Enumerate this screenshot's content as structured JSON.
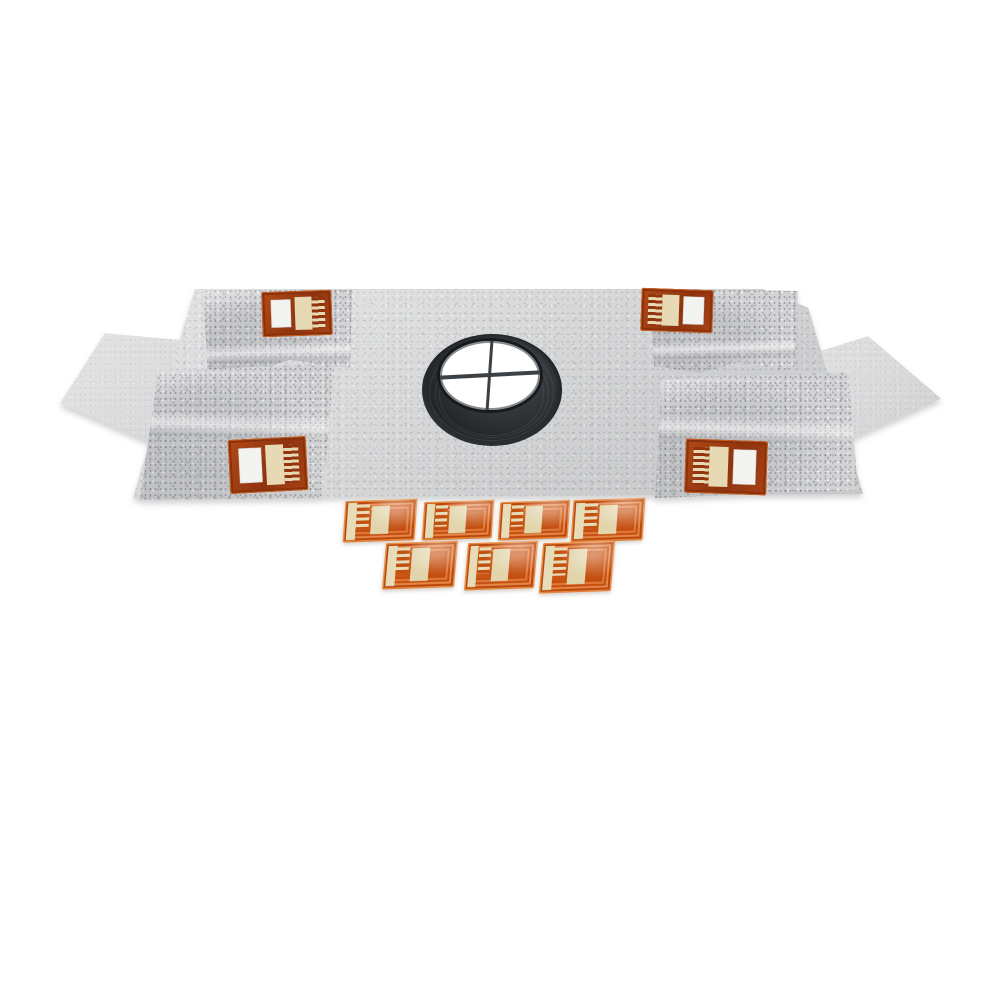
{
  "scene": {
    "description": "Product photo: gray nonwoven fleece waterproofing membrane kit with central drain collar, folded corner flaps, side wings, four embedded corner sensor tags and seven loose flexible sensor tags",
    "background_color": "#ffffff"
  },
  "membrane": {
    "fleece_color": "#d7d8d9",
    "flap_color": "#d2d3d5",
    "wing_count": 2,
    "corner_flap_count": 4
  },
  "corner_tags": {
    "count": 4,
    "frame_color": "#9e3c12",
    "window_color": "#f3f3f1",
    "pad_color": "#e6d9b3",
    "finger_color": "#92350e"
  },
  "drain_collar": {
    "ring_color": "#2c3033",
    "opening_color": "#ffffff",
    "crosshair": true,
    "crosshair_color": "#3c4145"
  },
  "loose_tags": {
    "count": 7,
    "row_counts": [
      4,
      3
    ],
    "body_color": "#cd5613",
    "trace_color": "#e98a3c",
    "strip_color": "#e7dcb8",
    "pad_color": "#e2d4ab"
  }
}
